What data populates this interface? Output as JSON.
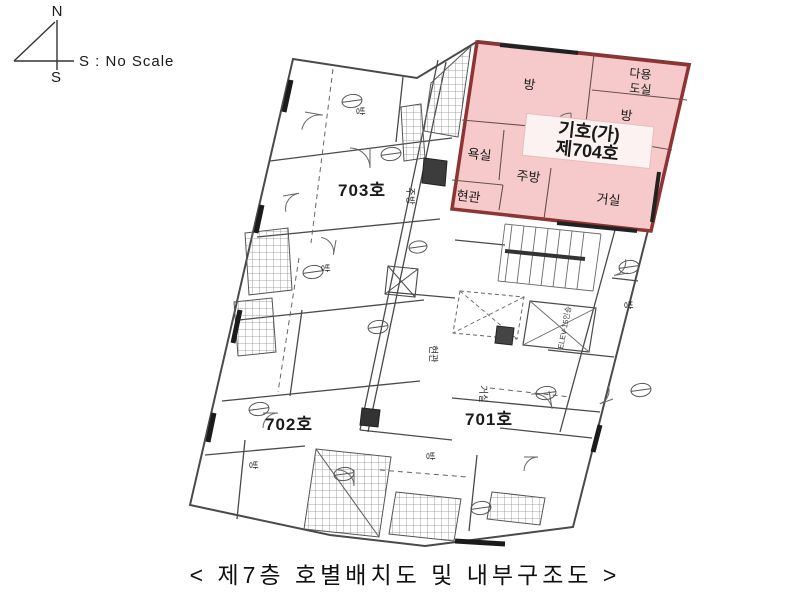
{
  "compass": {
    "north": "N",
    "south": "S",
    "note": "S : No Scale"
  },
  "caption": "< 제7층 호별배치도 및 내부구조도 >",
  "units": {
    "u703": "703호",
    "u702": "702호",
    "u701": "701호"
  },
  "unit704": {
    "tag_line1": "기호(가)",
    "tag_line2": "제704호",
    "rooms": {
      "room_top": "방",
      "utility_line1": "다용",
      "utility_line2": "도실",
      "room_right": "방",
      "bath": "욕실",
      "kitchen": "주방",
      "entrance": "현관",
      "living": "거실"
    }
  },
  "plan_labels": {
    "room1": "방",
    "room2": "방",
    "room3": "방",
    "room4": "방",
    "room5": "방",
    "kitchen": "주방",
    "entrance": "현관",
    "living": "거실",
    "elevator": "ELEV-15인승"
  },
  "colors": {
    "highlight_fill": "#f6caca",
    "highlight_border": "#8e3434",
    "highlight_text": "#e11616",
    "wall": "#4a4a4a"
  }
}
